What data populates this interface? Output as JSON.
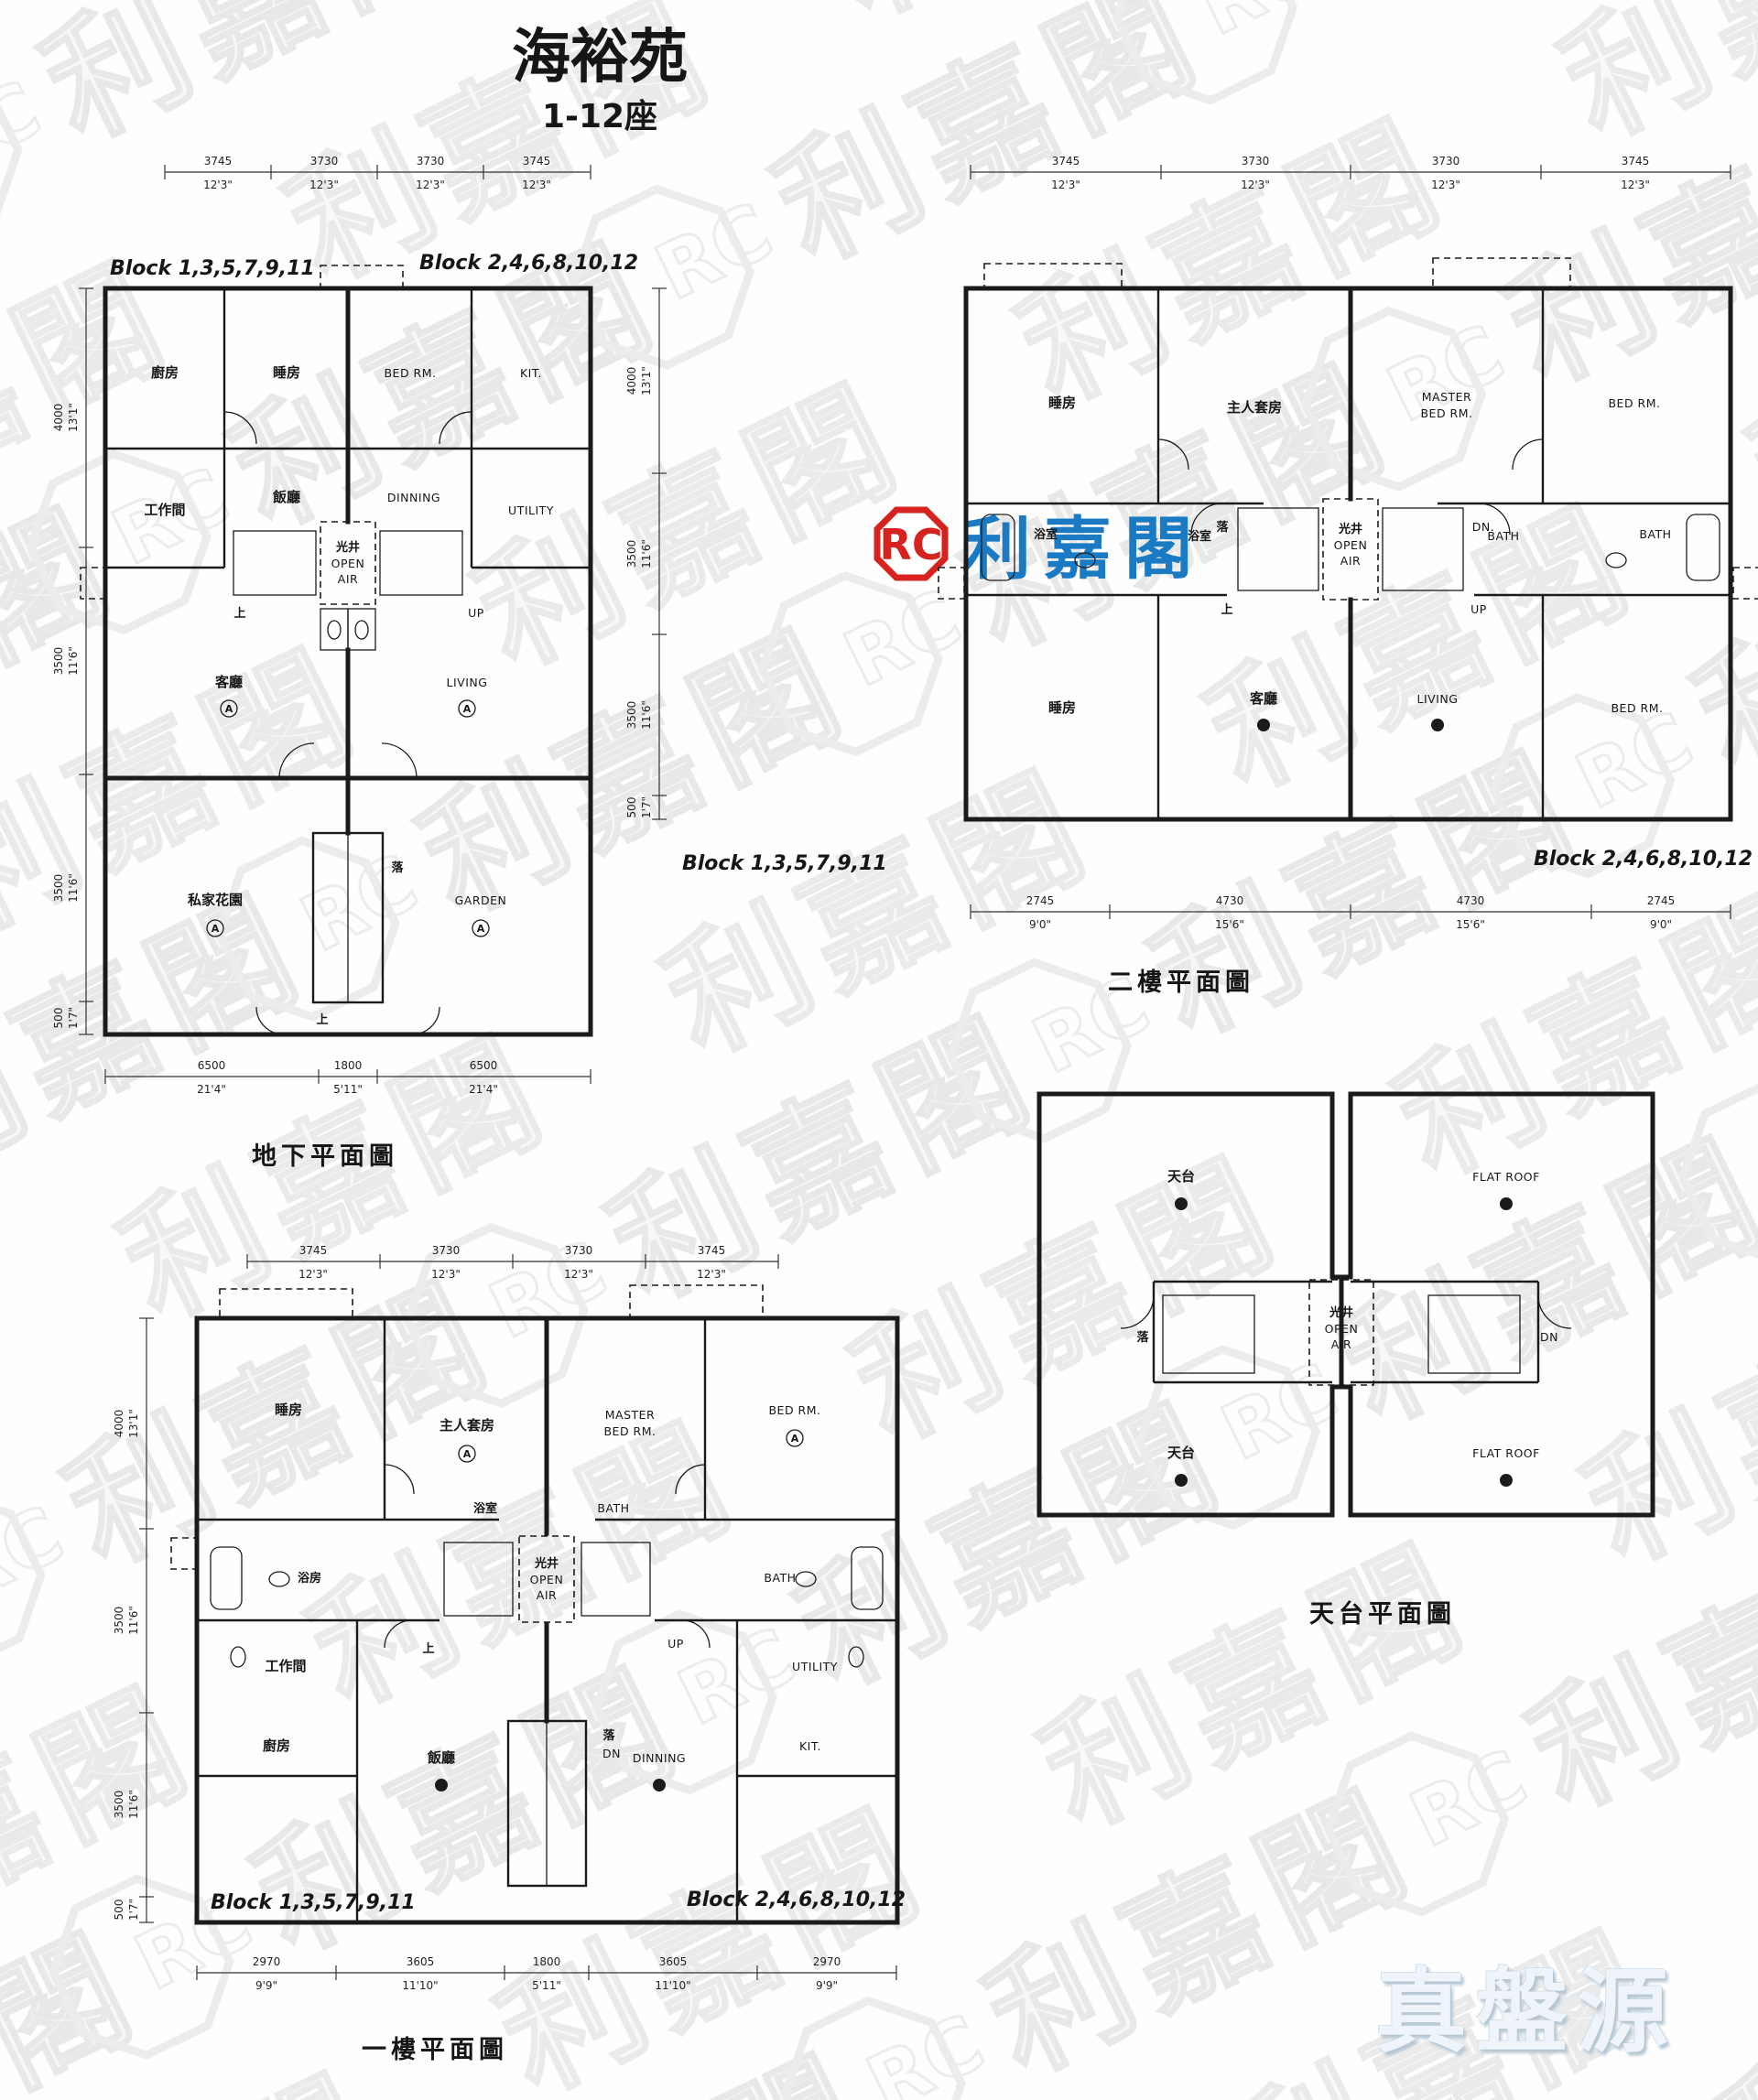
{
  "page": {
    "title": "海裕苑",
    "subtitle": "1-12座",
    "watermark": {
      "brand_cn": "利嘉閣",
      "brand_initials": "RC"
    },
    "center_logo": {
      "initials": "RC",
      "brand_cn": "利嘉閣"
    },
    "footer_logo": {
      "text": "真盤源"
    }
  },
  "shared": {
    "light_well_cn": "光井",
    "open": "OPEN",
    "air": "AIR",
    "up_cn": "上",
    "down_cn": "落",
    "up_en": "UP",
    "dn_en": "DN.",
    "dn_en_short": "DN",
    "marker_a": "A"
  },
  "plans": {
    "ground": {
      "caption": "地下平面圖",
      "block_left": "Block 1,3,5,7,9,11",
      "block_right": "Block 2,4,6,8,10,12",
      "dims_top": [
        {
          "mm": "3745",
          "ft": "12'3\""
        },
        {
          "mm": "3730",
          "ft": "12'3\""
        },
        {
          "mm": "3730",
          "ft": "12'3\""
        },
        {
          "mm": "3745",
          "ft": "12'3\""
        }
      ],
      "dims_left": [
        {
          "mm": "4000",
          "ft": "13'1\""
        },
        {
          "mm": "3500",
          "ft": "11'6\""
        },
        {
          "mm": "3500",
          "ft": "11'6\""
        },
        {
          "mm": "500",
          "ft": "1'7\""
        }
      ],
      "dims_bottom": [
        {
          "mm": "6500",
          "ft": "21'4\""
        },
        {
          "mm": "1800",
          "ft": "5'11\""
        },
        {
          "mm": "6500",
          "ft": "21'4\""
        }
      ],
      "rooms": {
        "kitchen_cn": "廚房",
        "bed_cn": "睡房",
        "work_cn": "工作間",
        "dining_cn": "飯廳",
        "living_cn": "客廳",
        "garden_cn": "私家花園",
        "bed_en": "BED RM.",
        "kit_en": "KIT.",
        "utility_en": "UTILITY",
        "dining_en": "DINNING",
        "living_en": "LIVING",
        "garden_en": "GARDEN"
      }
    },
    "second": {
      "caption": "二樓平面圖",
      "block_left": "Block 1,3,5,7,9,11",
      "block_right": "Block 2,4,6,8,10,12",
      "dims_top": [
        {
          "mm": "3745",
          "ft": "12'3\""
        },
        {
          "mm": "3730",
          "ft": "12'3\""
        },
        {
          "mm": "3730",
          "ft": "12'3\""
        },
        {
          "mm": "3745",
          "ft": "12'3\""
        }
      ],
      "dims_left": [
        {
          "mm": "4000",
          "ft": "13'1\""
        },
        {
          "mm": "3500",
          "ft": "11'6\""
        },
        {
          "mm": "3500",
          "ft": "11'6\""
        },
        {
          "mm": "500",
          "ft": "1'7\""
        }
      ],
      "dims_bottom": [
        {
          "mm": "2745",
          "ft": "9'0\""
        },
        {
          "mm": "4730",
          "ft": "15'6\""
        },
        {
          "mm": "4730",
          "ft": "15'6\""
        },
        {
          "mm": "2745",
          "ft": "9'0\""
        }
      ],
      "rooms": {
        "bed_cn": "睡房",
        "master_cn": "主人套房",
        "bath_cn": "浴室",
        "living_cn": "客廳",
        "master_en_1": "MASTER",
        "master_en_2": "BED RM.",
        "bed_en": "BED RM.",
        "bath_en": "BATH",
        "living_en": "LIVING"
      }
    },
    "first": {
      "caption": "一樓平面圖",
      "block_left": "Block 1,3,5,7,9,11",
      "block_right": "Block 2,4,6,8,10,12",
      "dims_top": [
        {
          "mm": "3745",
          "ft": "12'3\""
        },
        {
          "mm": "3730",
          "ft": "12'3\""
        },
        {
          "mm": "3730",
          "ft": "12'3\""
        },
        {
          "mm": "3745",
          "ft": "12'3\""
        }
      ],
      "dims_left": [
        {
          "mm": "4000",
          "ft": "13'1\""
        },
        {
          "mm": "3500",
          "ft": "11'6\""
        },
        {
          "mm": "3500",
          "ft": "11'6\""
        },
        {
          "mm": "500",
          "ft": "1'7\""
        }
      ],
      "dims_bottom": [
        {
          "mm": "2970",
          "ft": "9'9\""
        },
        {
          "mm": "3605",
          "ft": "11'10\""
        },
        {
          "mm": "1800",
          "ft": "5'11\""
        },
        {
          "mm": "3605",
          "ft": "11'10\""
        },
        {
          "mm": "2970",
          "ft": "9'9\""
        }
      ],
      "rooms": {
        "bed_cn": "睡房",
        "bath_left_cn": "浴房",
        "master_cn": "主人套房",
        "bath_cn": "浴室",
        "work_cn": "工作間",
        "kitchen_cn": "廚房",
        "dining_cn": "飯廳",
        "master_en_1": "MASTER",
        "master_en_2": "BED RM.",
        "bed_en": "BED RM.",
        "bath_en": "BATH",
        "utility_en": "UTILITY",
        "kit_en": "KIT.",
        "dining_en": "DINNING"
      }
    },
    "roof": {
      "caption": "天台平面圖",
      "rooms": {
        "roof_cn": "天台",
        "flat_roof_en": "FLAT ROOF"
      }
    }
  }
}
